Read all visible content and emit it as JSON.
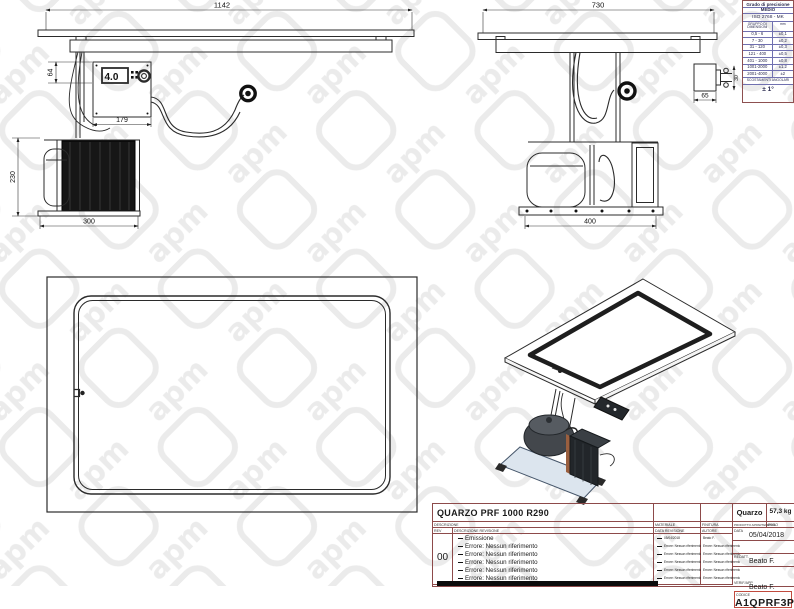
{
  "watermark": {
    "text": "apm",
    "color": "#ebebeb"
  },
  "precision_table": {
    "title": "Grado di precisione",
    "grade": "MEDIO",
    "standard": "ISO 2768 - MK",
    "col_dim": "GRUPPO DI DIMENSIONI",
    "col_unit": "mm",
    "rows": [
      {
        "range": "0,5 - 6",
        "tol": "±0,1"
      },
      {
        "range": "7 - 30",
        "tol": "±0,2"
      },
      {
        "range": "31 - 120",
        "tol": "±0,3"
      },
      {
        "range": "121 - 400",
        "tol": "±0,5"
      },
      {
        "range": "401 - 1000",
        "tol": "±0,8"
      },
      {
        "range": "1001-2000",
        "tol": "±1,2"
      },
      {
        "range": "2001-4000",
        "tol": "±2"
      }
    ],
    "angular_label": "SCOSTAMENTI ANGOLARI",
    "angular_value": "± 1°"
  },
  "views": {
    "front": {
      "display_value": "4.0",
      "dims": {
        "top_width": "1142",
        "panel_height": "64",
        "panel_width": "179",
        "unit_height": "230",
        "unit_width": "300"
      }
    },
    "side": {
      "dims": {
        "top_width": "730",
        "connector_length": "65",
        "connector_dia": "30",
        "unit_width": "400"
      }
    }
  },
  "title_block": {
    "description": "QUARZO PRF 1000 R290",
    "description_label": "DESCRIZIONE",
    "rev_label": "REV",
    "rev_desc_label": "DESCRIZIONE REVISIONE",
    "materiale_label": "MATERIALE",
    "data_revisione_label": "DATA REVISIONE",
    "finitura_label": "FINITURA",
    "autore_label": "AUTORE",
    "prodotto_label": "PRODOTTO APPARTENENZA",
    "peso_label": "PESO",
    "product": "Quarzo",
    "weight": "57,3 kg",
    "data_label": "DATA",
    "date": "05/04/2018",
    "redatt_label": "REDATT.",
    "redatt_value": "Beato F.",
    "verif_label": "VERIF/APP",
    "verif_value": "Beato F.",
    "codice_label": "CODICE",
    "code": "A1QPRF3P",
    "rev_number": "00",
    "revisions": [
      {
        "desc": "Emissione",
        "date": "05/04/2018",
        "author": "Beato F."
      },
      {
        "desc": "Errore: Nessun riferimento",
        "date": "Errore: Nessun riferimento",
        "author": "Errore: Nessun riferimento"
      },
      {
        "desc": "Errore: Nessun riferimento",
        "date": "Errore: Nessun riferimento",
        "author": "Errore: Nessun riferimento"
      },
      {
        "desc": "Errore: Nessun riferimento",
        "date": "Errore: Nessun riferimento",
        "author": "Errore: Nessun riferimento"
      },
      {
        "desc": "Errore: Nessun riferimento",
        "date": "Errore: Nessun riferimento",
        "author": "Errore: Nessun riferimento"
      },
      {
        "desc": "Errore: Nessun riferimento",
        "date": "Errore: Nessun riferimento",
        "author": "Errore: Nessun riferimento"
      }
    ]
  }
}
